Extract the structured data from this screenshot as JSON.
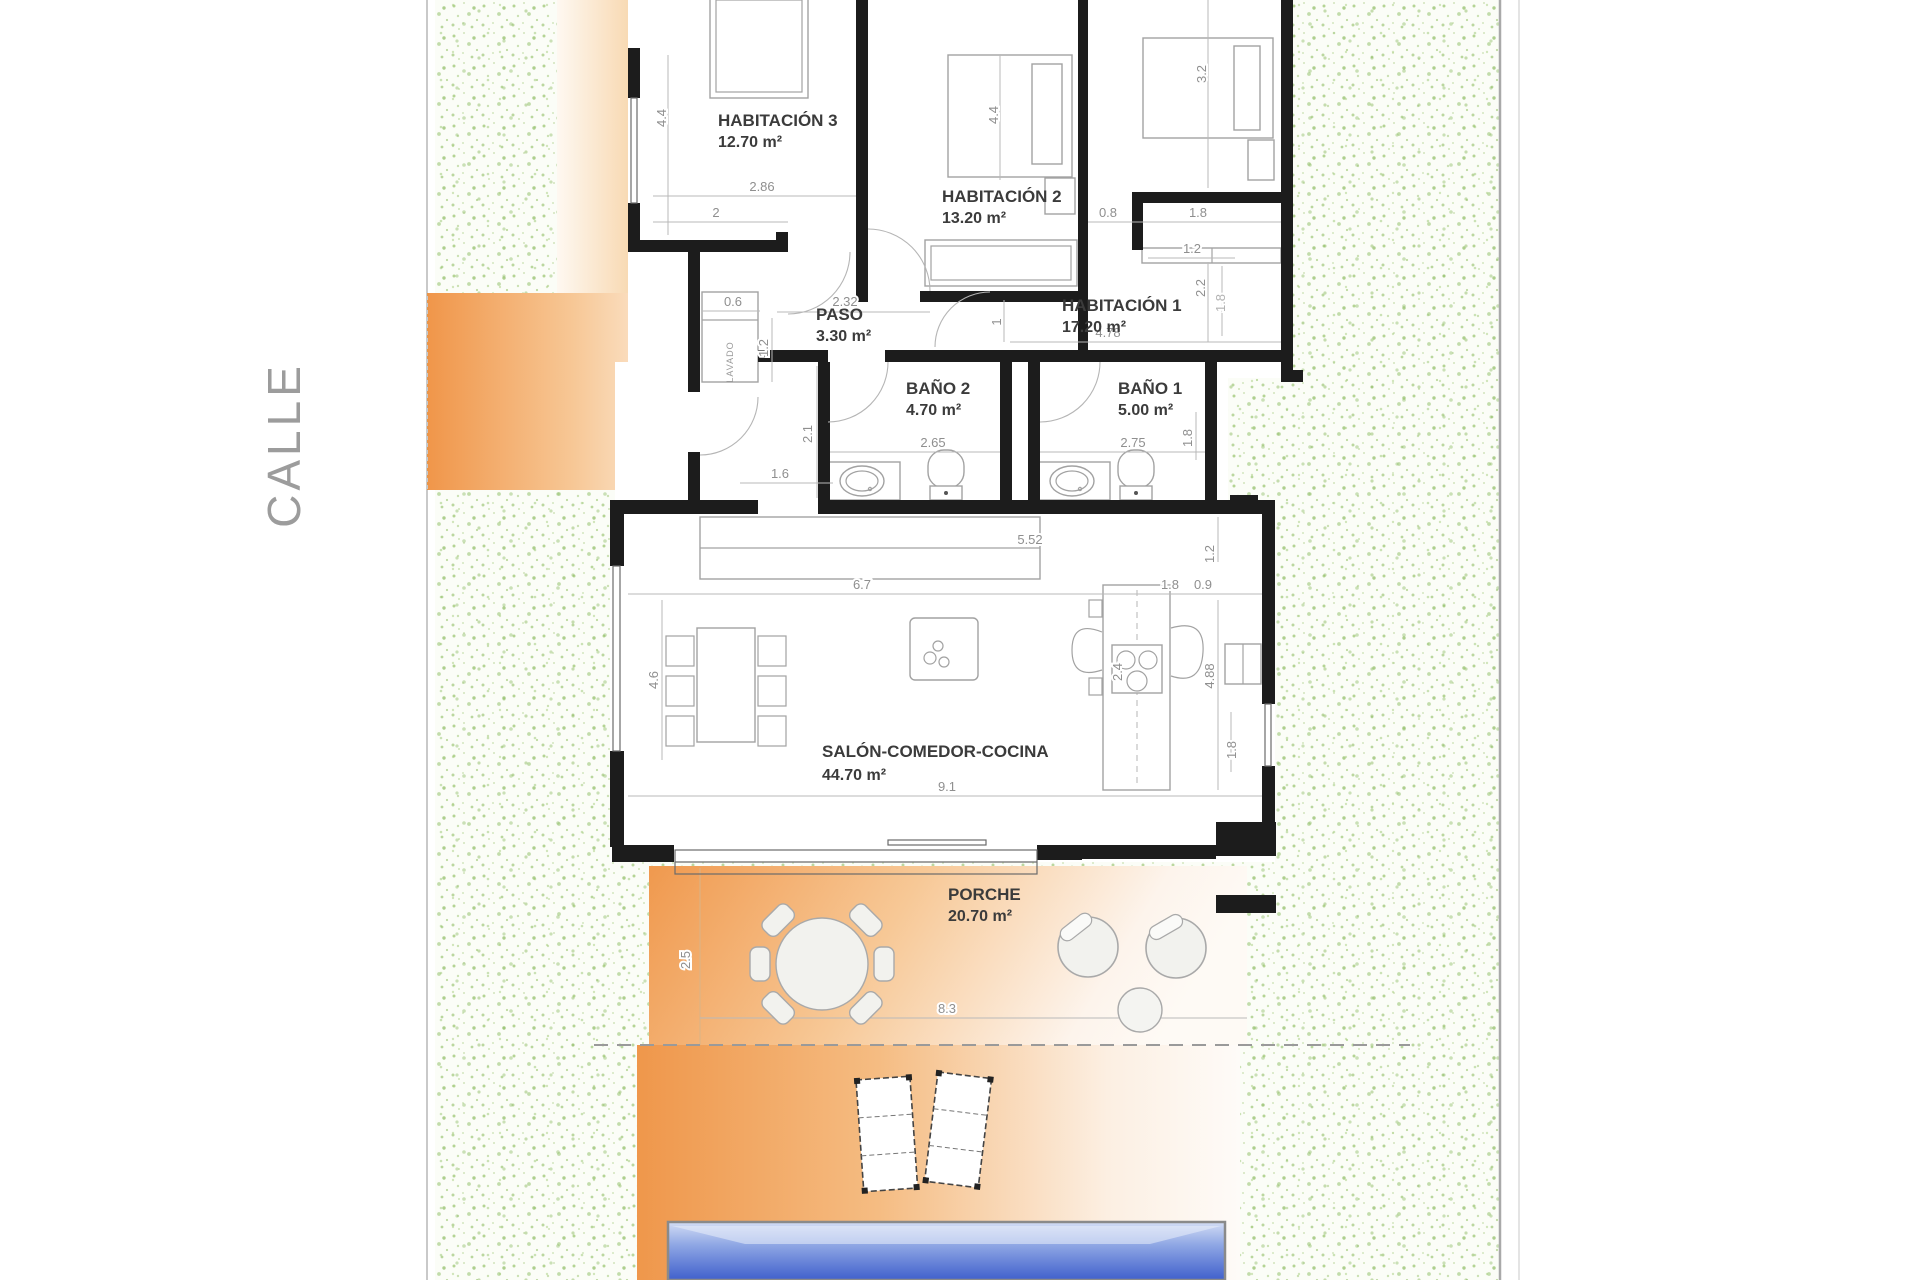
{
  "street": {
    "label": "CALLE"
  },
  "utility": {
    "label": "LAVADO"
  },
  "rooms": [
    {
      "name": "HABITACIÓN 3",
      "area": "12.70 m²"
    },
    {
      "name": "HABITACIÓN 2",
      "area": "13.20 m²"
    },
    {
      "name": "HABITACIÓN 1",
      "area": "17.20 m²"
    },
    {
      "name": "PASO",
      "area": "3.30 m²"
    },
    {
      "name": "BAÑO 2",
      "area": "4.70 m²"
    },
    {
      "name": "BAÑO 1",
      "area": "5.00 m²"
    },
    {
      "name": "SALÓN-COMEDOR-COCINA",
      "area": "44.70 m²"
    },
    {
      "name": "PORCHE",
      "area": "20.70 m²"
    }
  ],
  "dims": [
    "4.4",
    "2.86",
    "2",
    "4.4",
    "3.2",
    "0.8",
    "1.8",
    "1.2",
    "2.2",
    "1.8",
    "1",
    "4.78",
    "0.6",
    "2.32",
    "1.2",
    "2.1",
    "1.6",
    "2.65",
    "2.75",
    "1.8",
    "5.52",
    "1.2",
    "6.7",
    "1.8",
    "0.9",
    "4.6",
    "2.4",
    "4.88",
    "9.1",
    "1.8",
    "2.5",
    "8.3"
  ],
  "colors": {
    "wall": "#1c1c1c",
    "furniture_line": "#a2a2a2",
    "dim_text": "#8f8f8f",
    "label_text": "#3b3b3b",
    "grass_dot": "#a3cb7c",
    "orange": "#f0964a",
    "orange_light": "#fdf3e7",
    "pool_top": "#d3ddf5",
    "pool_bottom": "#4060cc"
  }
}
